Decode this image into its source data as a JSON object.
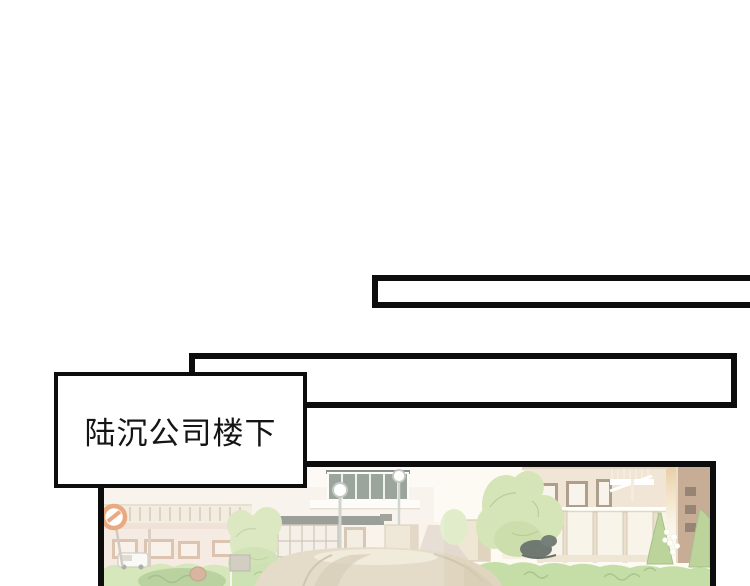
{
  "page": {
    "kind": "comic page",
    "background": "#ffffff"
  },
  "caption_box": {
    "text": "陆沉公司楼下"
  },
  "narration_boxes": {
    "top": {
      "text": ""
    },
    "middle": {
      "text": ""
    }
  },
  "panel": {
    "scene_alt": "hazy daylight view of an office-building courtyard: pale pink and beige buildings, rooftop glass structure, street lamps, no-entry sign, white van, white wall, trees and hedge, beige car in the foreground",
    "palette": {
      "ink": "#0d0d0d",
      "paper": "#ffffff",
      "haze": "#fcf7ef",
      "bldg_pink": "#f2dfd2",
      "bldg_beige": "#ecdcc5",
      "bldg_brown": "#b28e6e",
      "glass_structure": "#5f6f60",
      "tree": "#c6db9d",
      "tree_line": "#9abd70",
      "conifer": "#a3c477",
      "hedge": "#afd186",
      "hedge_line": "#7fa857",
      "road": "#d9cbbb",
      "car": "#d4c6a8",
      "sign": "#dd7636",
      "glow": "#e0ba80",
      "dark_accent": "#38443b"
    }
  }
}
